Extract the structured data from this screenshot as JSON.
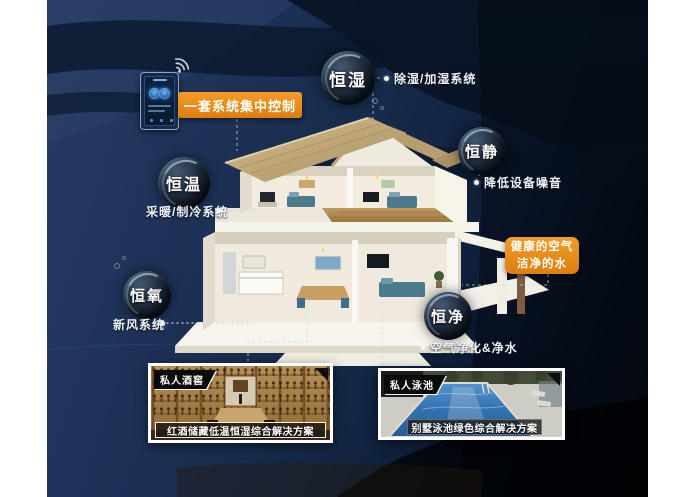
{
  "control": {
    "label": "一套系统集中控制"
  },
  "healthy": {
    "line1": "健康的空气",
    "line2": "洁净的水"
  },
  "bubbles": [
    {
      "name": "humidity",
      "label": "恒湿",
      "desc": "除湿/加湿系统"
    },
    {
      "name": "quiet",
      "label": "恒静",
      "desc": "降低设备噪音"
    },
    {
      "name": "temperature",
      "label": "恒温",
      "desc": "采暖/制冷系统"
    },
    {
      "name": "oxygen",
      "label": "恒氧",
      "desc": "新风系统"
    },
    {
      "name": "purify",
      "label": "恒净",
      "desc": "空气净化&净水"
    }
  ],
  "cards": [
    {
      "badge": "私人酒窖",
      "caption": "红酒储藏低温恒湿综合解决方案",
      "image": "wine-cellar-photo"
    },
    {
      "badge": "私人泳池",
      "caption": "别墅泳池绿色综合解决方案",
      "image": "swimming-pool-photo"
    }
  ],
  "icons": {
    "wifi": "wifi-icon",
    "phone": "smart-controller-phone"
  },
  "colors": {
    "accent_orange": "#e8891d",
    "background_navy": "#16294a",
    "card_border": "#ffffff",
    "label_text": "#ffffff"
  }
}
